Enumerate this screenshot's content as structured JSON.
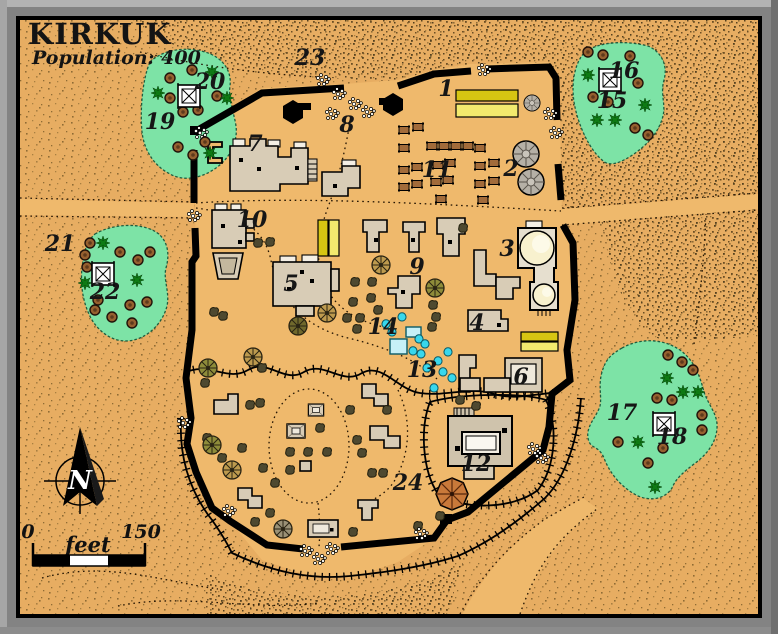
{
  "title": "KIRKUK",
  "subtitle": "Population: 400",
  "compass": {
    "north_letter": "N"
  },
  "scale_bar": {
    "start": "0",
    "unit": "feet",
    "end": "150"
  },
  "map_labels": [
    {
      "n": "1",
      "x": 446,
      "y": 96
    },
    {
      "n": "2",
      "x": 511,
      "y": 176
    },
    {
      "n": "3",
      "x": 507,
      "y": 256
    },
    {
      "n": "4",
      "x": 477,
      "y": 330
    },
    {
      "n": "5",
      "x": 291,
      "y": 291
    },
    {
      "n": "6",
      "x": 521,
      "y": 384
    },
    {
      "n": "7",
      "x": 255,
      "y": 151
    },
    {
      "n": "8",
      "x": 347,
      "y": 132
    },
    {
      "n": "9",
      "x": 417,
      "y": 274
    },
    {
      "n": "10",
      "x": 252,
      "y": 227
    },
    {
      "n": "11",
      "x": 437,
      "y": 177
    },
    {
      "n": "12",
      "x": 476,
      "y": 471
    },
    {
      "n": "13",
      "x": 422,
      "y": 377
    },
    {
      "n": "14",
      "x": 383,
      "y": 334
    },
    {
      "n": "15",
      "x": 612,
      "y": 108
    },
    {
      "n": "16",
      "x": 624,
      "y": 78
    },
    {
      "n": "17",
      "x": 622,
      "y": 420
    },
    {
      "n": "18",
      "x": 672,
      "y": 444
    },
    {
      "n": "19",
      "x": 160,
      "y": 129
    },
    {
      "n": "20",
      "x": 210,
      "y": 89
    },
    {
      "n": "21",
      "x": 60,
      "y": 251
    },
    {
      "n": "22",
      "x": 105,
      "y": 299
    },
    {
      "n": "23",
      "x": 310,
      "y": 65
    },
    {
      "n": "24",
      "x": 408,
      "y": 490
    }
  ],
  "colors": {
    "sand": "#E7AD62",
    "sand_smooth": "#EFB96C",
    "speckle": "#8F6B35",
    "dune_speckle": "#54401E",
    "oasis_green": "#7DE3A6",
    "wall_black": "#000000",
    "building": "#D8CCB6",
    "yellow_dark": "#D6C512",
    "yellow_pale": "#F2EA6E",
    "water_cyan": "#38D7EC",
    "pool_blue": "#C6F0F7",
    "stall_brown": "#A26B3A",
    "tent_gray": "#B5B0A6",
    "tent_orange": "#C9793A",
    "dome_cream": "#F8F1CE",
    "tree_brown": "#96602F",
    "palm_green": "#0E7A14",
    "frame_gray": "#838383"
  }
}
